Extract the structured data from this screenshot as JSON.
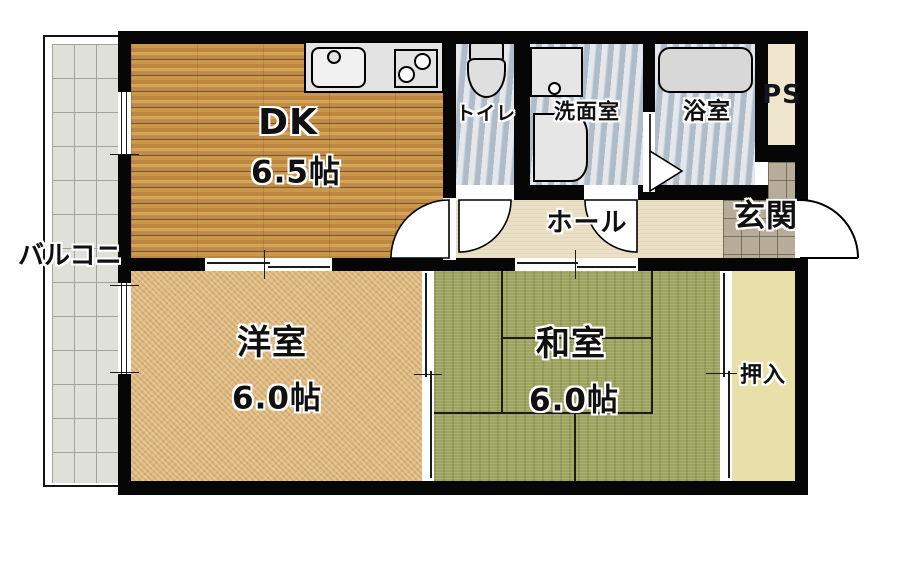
{
  "plan": {
    "title": "2DK apartment floor plan",
    "rooms": {
      "dk": {
        "label": "DK",
        "size": "6.5帖"
      },
      "western": {
        "label": "洋室",
        "size": "6.0帖"
      },
      "japanese": {
        "label": "和室",
        "size": "6.0帖"
      },
      "toilet": {
        "label": "トイレ"
      },
      "washroom": {
        "label": "洗面室"
      },
      "bathroom": {
        "label": "浴室"
      },
      "hall": {
        "label": "ホール"
      },
      "entrance": {
        "label": "玄関"
      },
      "pipe_space": {
        "label": "PS"
      },
      "closet": {
        "label": "押入"
      },
      "balcony": {
        "label": "バルコニー"
      }
    },
    "colors": {
      "wall": "#060606",
      "wood_floor": "#C8944C",
      "carpet_floor": "#D9B377",
      "tatami_floor": "#9CA45F",
      "wet_floor": "#C3CDD6",
      "hall_floor": "#EAE0C6",
      "closet_floor": "#E9DFA9",
      "entrance_tile": "#B6AC98",
      "balcony_tile": "#E0E0DB"
    }
  }
}
